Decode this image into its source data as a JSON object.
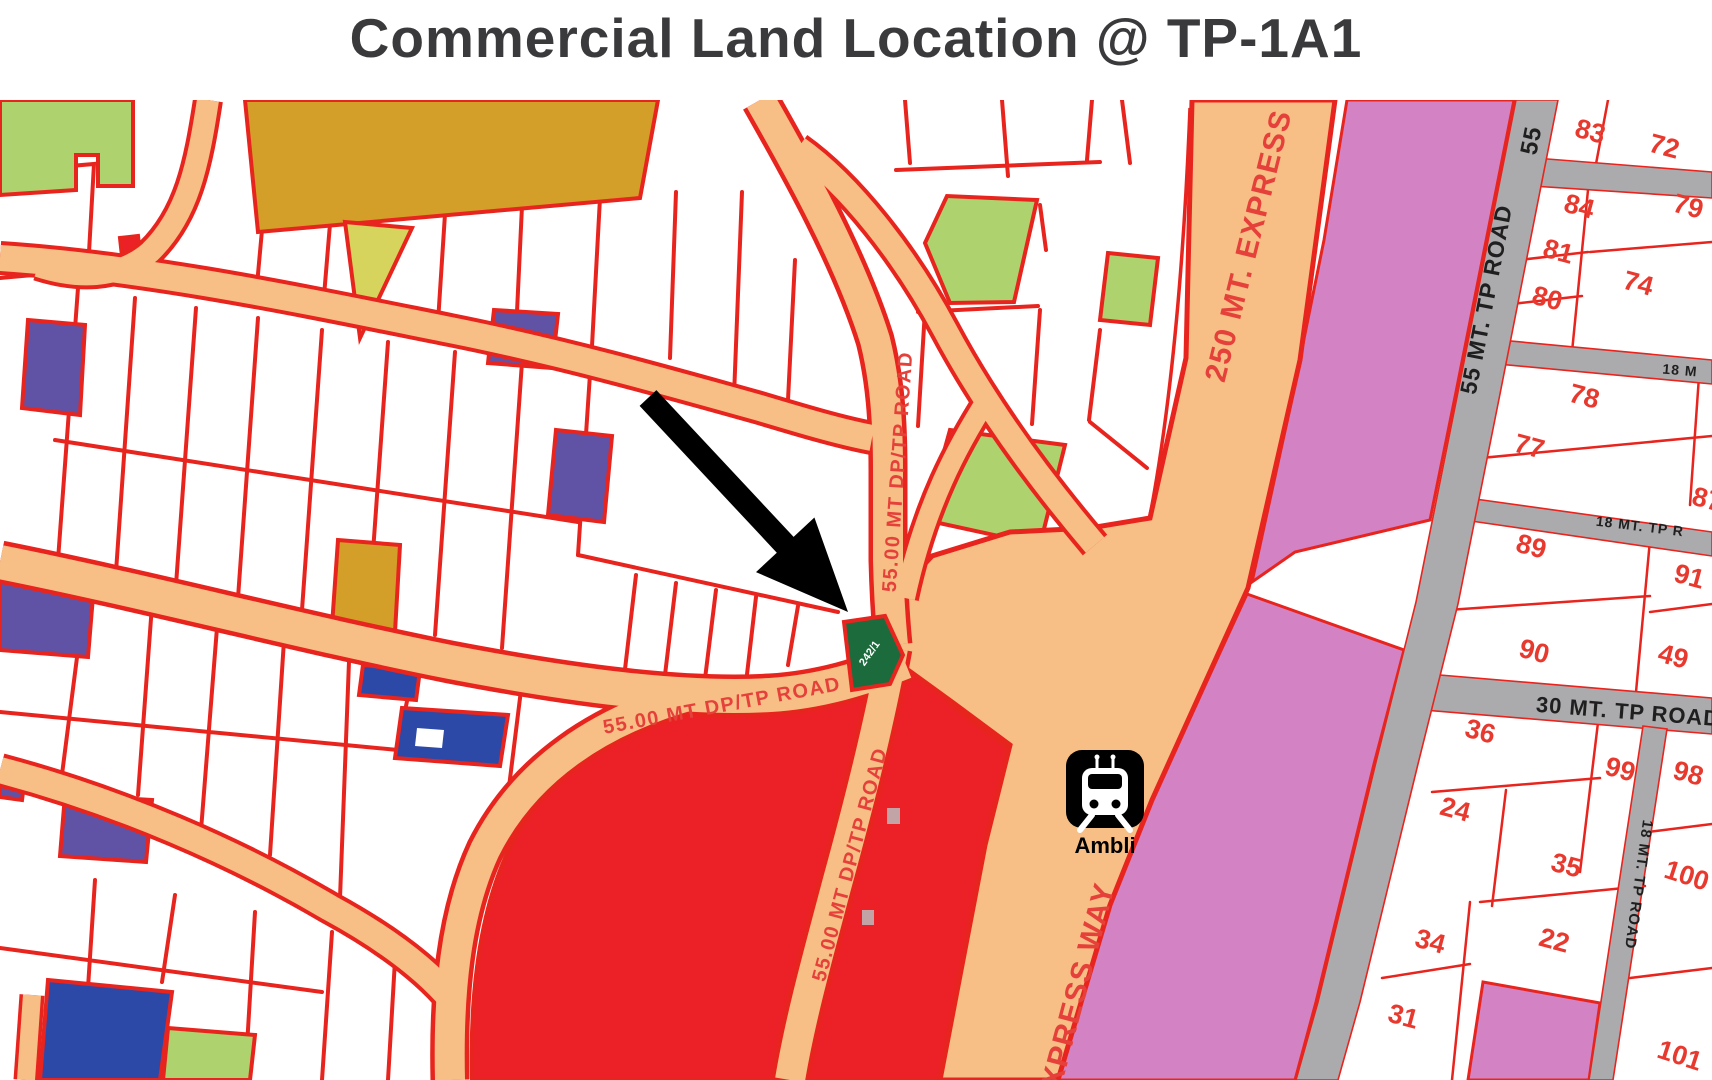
{
  "title": "Commercial Land Location @ TP-1A1",
  "map": {
    "target_plot": {
      "label": "242/1",
      "color": "#1c6b3c"
    },
    "station": {
      "name": "Ambli"
    },
    "road_labels": [
      {
        "id": "dptp-road-upper-vertical",
        "text": "55.00 MT DP/TP ROAD"
      },
      {
        "id": "dptp-road-horizontal",
        "text": "55.00 MT DP/TP ROAD"
      },
      {
        "id": "dptp-road-lower-vertical",
        "text": "55.00 MT DP/TP ROAD"
      },
      {
        "id": "expressway-upper",
        "text": "250 MT.  EXPRESS"
      },
      {
        "id": "expressway-lower",
        "text": "EXPRESS WAY"
      },
      {
        "id": "tp-road-55-top",
        "text": "55"
      },
      {
        "id": "tp-road-55-main",
        "text": "55 MT. TP ROAD"
      },
      {
        "id": "tp-road-18-upper",
        "text": "18 M"
      },
      {
        "id": "tp-road-18-mid",
        "text": "18 MT. TP R"
      },
      {
        "id": "tp-road-30",
        "text": "30 MT.  TP ROAD"
      },
      {
        "id": "tp-road-18-vertical",
        "text": "18 MT. TP ROAD"
      }
    ],
    "plot_numbers": [
      "83",
      "72",
      "84",
      "79",
      "81",
      "80",
      "74",
      "78",
      "77",
      "89",
      "87",
      "91",
      "90",
      "49",
      "36",
      "99",
      "98",
      "24",
      "35",
      "22",
      "100",
      "34",
      "31",
      "101"
    ],
    "colors": {
      "road_orange": "#f7bf85",
      "road_border_red": "#e8241e",
      "parcel_white": "#ffffff",
      "pink_zone": "#d383c4",
      "gray_road": "#ababad",
      "red_zone": "#ec2127",
      "purple_plot": "#6053a6",
      "blue_plot": "#2c49a8",
      "green_plot": "#aed26e",
      "olive_plot": "#d6d45c",
      "ochre_plot": "#d39f28",
      "target_green": "#1c6b3c",
      "label_red": "#e5413a"
    }
  }
}
